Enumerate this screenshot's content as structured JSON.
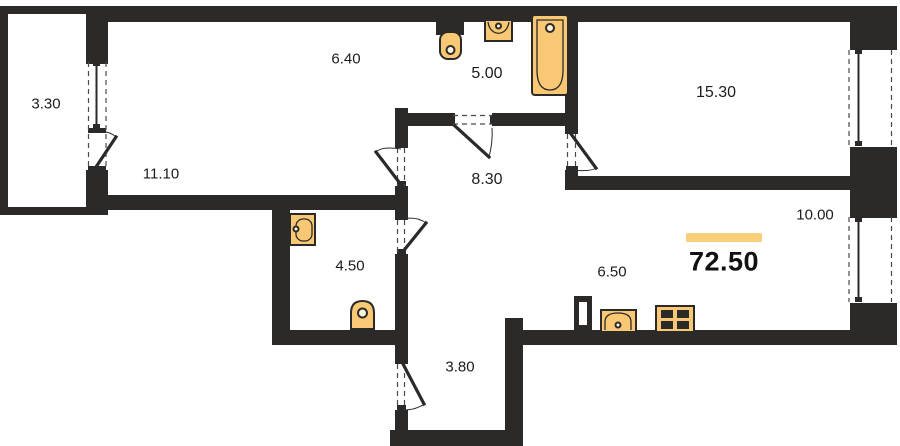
{
  "plan": {
    "type": "apartment-floor-plan",
    "total": {
      "area": "72.50"
    },
    "rooms": [
      {
        "id": "balcony",
        "area": "3.30"
      },
      {
        "id": "bedroom-left",
        "area": "11.10"
      },
      {
        "id": "wardrobe",
        "area": "6.40"
      },
      {
        "id": "bathroom-top",
        "area": "5.00"
      },
      {
        "id": "bedroom-right",
        "area": "15.30"
      },
      {
        "id": "hallway",
        "area": "8.30"
      },
      {
        "id": "living-zone",
        "area": "10.00"
      },
      {
        "id": "wc",
        "area": "4.50"
      },
      {
        "id": "kitchen-zone",
        "area": "6.50"
      },
      {
        "id": "entry-hall",
        "area": "3.80"
      }
    ],
    "fixtures": [
      {
        "name": "toilet-icon"
      },
      {
        "name": "washbasin-icon"
      },
      {
        "name": "bathtub-icon"
      },
      {
        "name": "washbasin-icon"
      },
      {
        "name": "toilet-icon"
      },
      {
        "name": "kitchen-sink-icon"
      },
      {
        "name": "stove-icon"
      },
      {
        "name": "ventilation-duct-icon"
      }
    ],
    "colors": {
      "wall": "#2c2a28",
      "fixture_fill": "#f8c874",
      "accent_bar": "#f9cf7a",
      "window_line": "#4a4a4a",
      "text": "#1c1c1c",
      "background": "#ffffff"
    }
  }
}
